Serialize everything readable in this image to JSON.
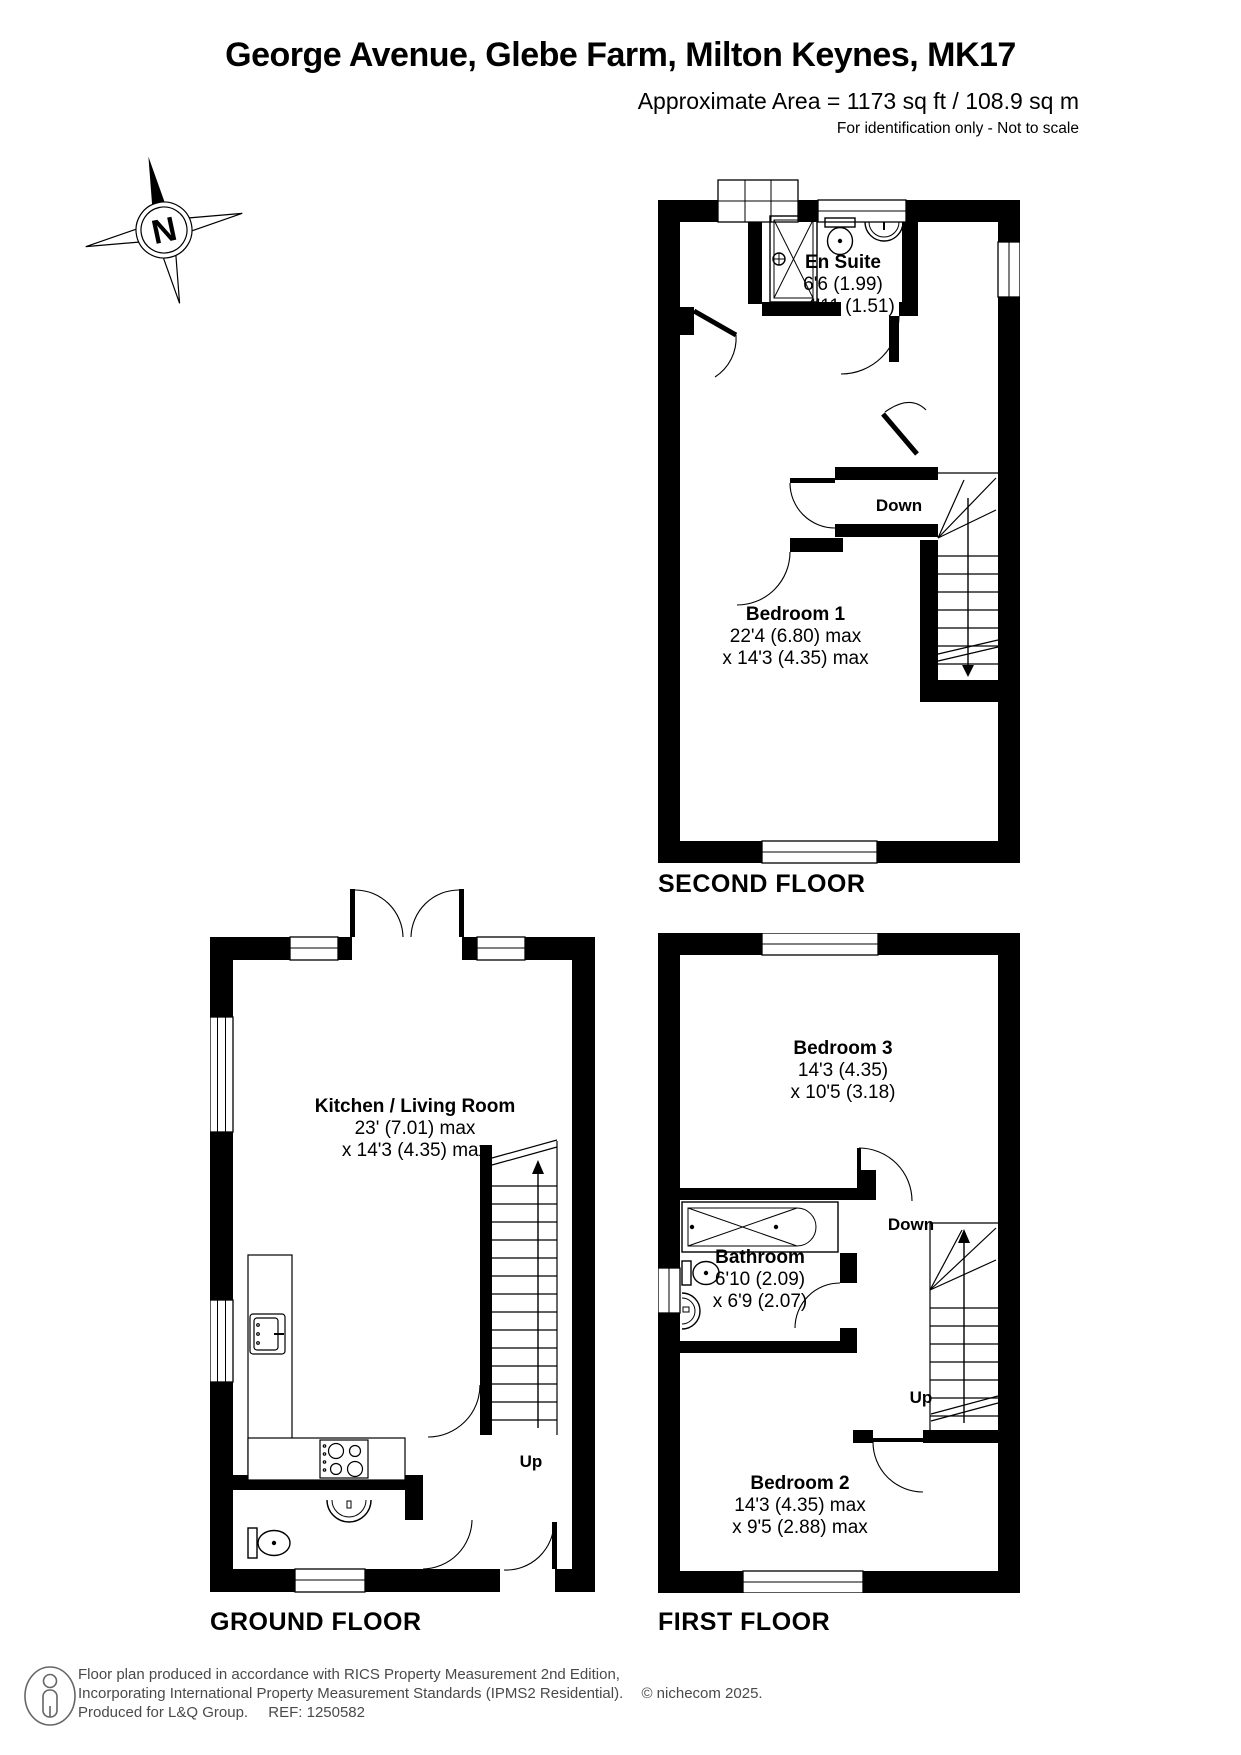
{
  "header": {
    "title": "George Avenue, Glebe Farm, Milton Keynes, MK17",
    "area_line": "Approximate Area = 1173 sq ft / 108.9 sq m",
    "disclaimer": "For identification only - Not to scale"
  },
  "compass": {
    "north_letter": "N"
  },
  "floors": {
    "second": {
      "caption": "SECOND FLOOR",
      "rooms": [
        {
          "name": "En Suite",
          "dims": [
            "6'6 (1.99)",
            "x 4'11 (1.51)"
          ]
        },
        {
          "name": "Bedroom 1",
          "dims": [
            "22'4 (6.80) max",
            "x 14'3 (4.35) max"
          ]
        }
      ],
      "labels": {
        "down": "Down"
      }
    },
    "first": {
      "caption": "FIRST FLOOR",
      "rooms": [
        {
          "name": "Bedroom 3",
          "dims": [
            "14'3 (4.35)",
            "x 10'5 (3.18)"
          ]
        },
        {
          "name": "Bathroom",
          "dims": [
            "6'10 (2.09)",
            "x 6'9 (2.07)"
          ]
        },
        {
          "name": "Bedroom 2",
          "dims": [
            "14'3 (4.35) max",
            "x 9'5 (2.88) max"
          ]
        }
      ],
      "labels": {
        "down": "Down",
        "up": "Up"
      }
    },
    "ground": {
      "caption": "GROUND FLOOR",
      "rooms": [
        {
          "name": "Kitchen / Living Room",
          "dims": [
            "23' (7.01) max",
            "x 14'3 (4.35) max"
          ]
        }
      ],
      "labels": {
        "up": "Up"
      }
    }
  },
  "footer": {
    "line1": "Floor plan produced in accordance with RICS Property Measurement 2nd Edition,",
    "line2": "Incorporating International Property Measurement Standards (IPMS2 Residential).",
    "copyright": "© nichecom 2025.",
    "line3a": "Produced for L&Q Group.",
    "line3b": "REF: 1250582"
  }
}
